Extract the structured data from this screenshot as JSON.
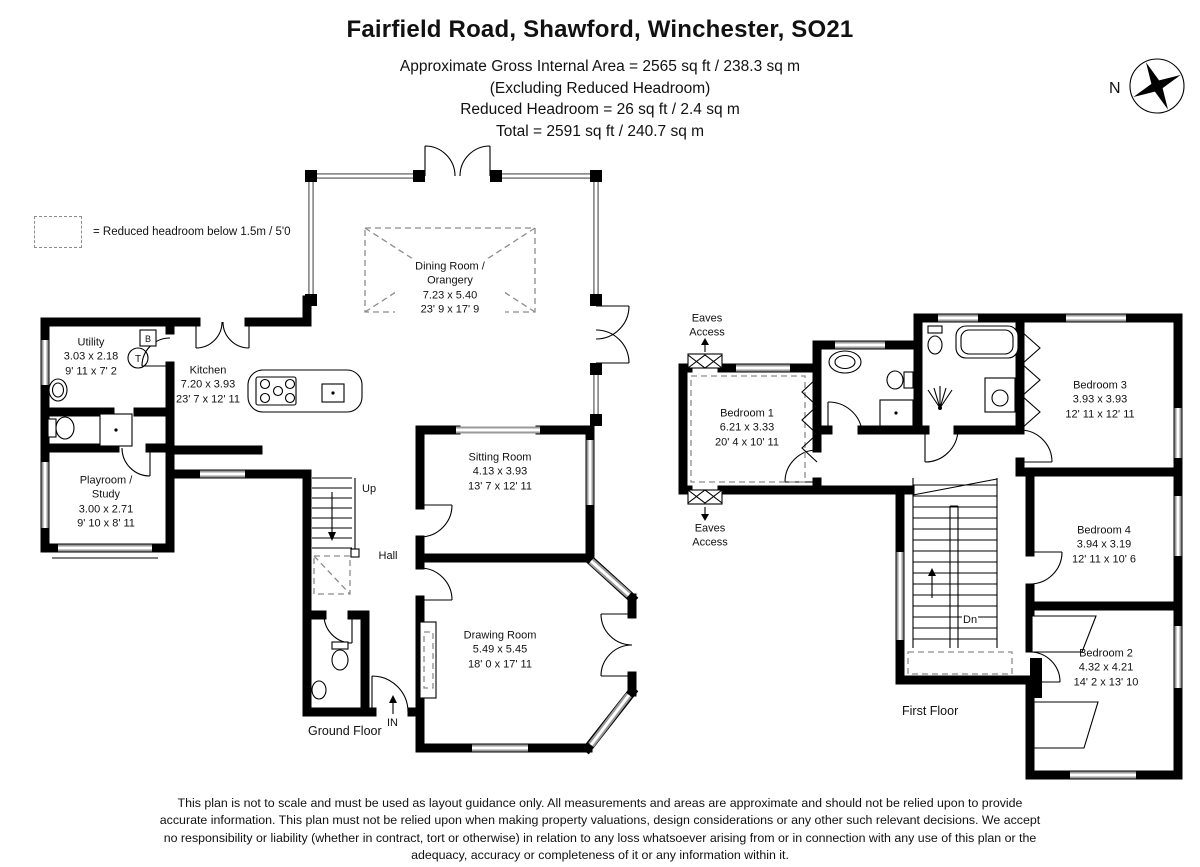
{
  "header": {
    "title": "Fairfield Road, Shawford, Winchester, SO21",
    "line1": "Approximate Gross Internal Area = 2565 sq ft / 238.3 sq m",
    "line2": "(Excluding Reduced Headroom)",
    "line3": "Reduced Headroom = 26 sq ft / 2.4 sq m",
    "line4": "Total = 2591 sq ft / 240.7 sq m"
  },
  "compass": {
    "label": "N"
  },
  "legend": {
    "label": "= Reduced headroom below 1.5m / 5'0"
  },
  "ground_floor": {
    "floor_label": "Ground Floor",
    "rooms": {
      "utility": {
        "name": "Utility",
        "metric": "3.03 x 2.18",
        "imperial": "9' 11 x 7' 2"
      },
      "kitchen": {
        "name": "Kitchen",
        "metric": "7.20 x 3.93",
        "imperial": "23' 7 x 12' 11"
      },
      "playroom_study": {
        "name": "Playroom / Study",
        "metric": "3.00 x 2.71",
        "imperial": "9' 10 x 8' 11"
      },
      "dining_orangery": {
        "name": "Dining Room / Orangery",
        "metric": "7.23 x 5.40",
        "imperial": "23' 9 x 17' 9"
      },
      "sitting_room": {
        "name": "Sitting Room",
        "metric": "4.13 x 3.93",
        "imperial": "13' 7 x 12' 11"
      },
      "hall": {
        "name": "Hall"
      },
      "drawing_room": {
        "name": "Drawing Room",
        "metric": "5.49 x 5.45",
        "imperial": "18' 0 x 17' 11"
      }
    },
    "annotations": {
      "up": "Up",
      "in": "IN",
      "tank": "T",
      "boiler": "B"
    }
  },
  "first_floor": {
    "floor_label": "First Floor",
    "rooms": {
      "bedroom_1": {
        "name": "Bedroom 1",
        "metric": "6.21 x 3.33",
        "imperial": "20' 4 x 10' 11"
      },
      "bedroom_2": {
        "name": "Bedroom 2",
        "metric": "4.32 x 4.21",
        "imperial": "14' 2 x 13' 10"
      },
      "bedroom_3": {
        "name": "Bedroom 3",
        "metric": "3.93 x 3.93",
        "imperial": "12' 11 x 12' 11"
      },
      "bedroom_4": {
        "name": "Bedroom 4",
        "metric": "3.94 x 3.19",
        "imperial": "12' 11 x 10' 6"
      }
    },
    "annotations": {
      "dn": "Dn",
      "eaves": "Eaves Access"
    }
  },
  "footer": {
    "disclaimer": "This plan is not to scale and must be used as layout guidance only. All measurements and areas are approximate and should not be relied upon to provide accurate information. This plan must not be relied upon when making property valuations, design considerations or any other such relevant decisions. We accept no responsibility or liability (whether in contract, tort or otherwise) in relation to any loss whatsoever arising from or in connection with any use of this plan or the adequacy, accuracy or completeness of it or any information within it."
  }
}
